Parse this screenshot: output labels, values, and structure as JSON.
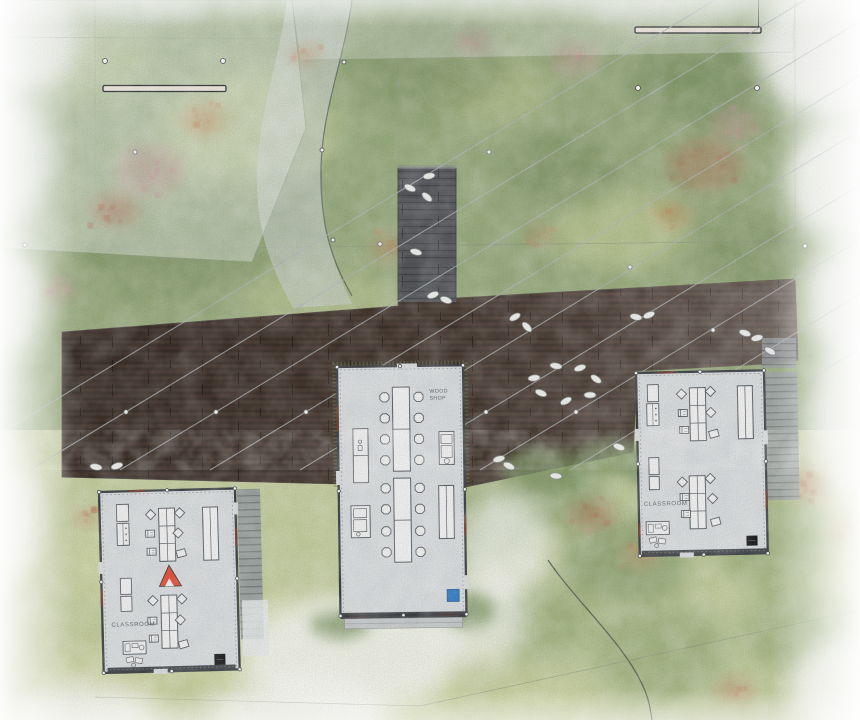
{
  "buildings": {
    "west_classroom": {
      "label": "CLASSROOM"
    },
    "wood_shop": {
      "label_line1": "WOOD",
      "label_line2": "SHOP"
    },
    "east_classroom": {
      "label": "CLASSROOM"
    }
  },
  "colors": {
    "meadow_north": "#9bae81",
    "meadow_south": "#c6cfa0",
    "deck_wood": "#4a3c33",
    "walkway_wood": "#55575b",
    "building_floor": "#dcdfe1",
    "wall_line": "#3f4347",
    "accent_red": "#e8503a",
    "accent_blue": "#2e7bc4",
    "flower_pink": "#d492a4",
    "flower_orange": "#cd7f52",
    "flower_red": "#bd5a49",
    "stone_fill": "#f1f2ef",
    "cable_gray": "#b3b9bc",
    "stair_gray": "#9aa0a3"
  }
}
